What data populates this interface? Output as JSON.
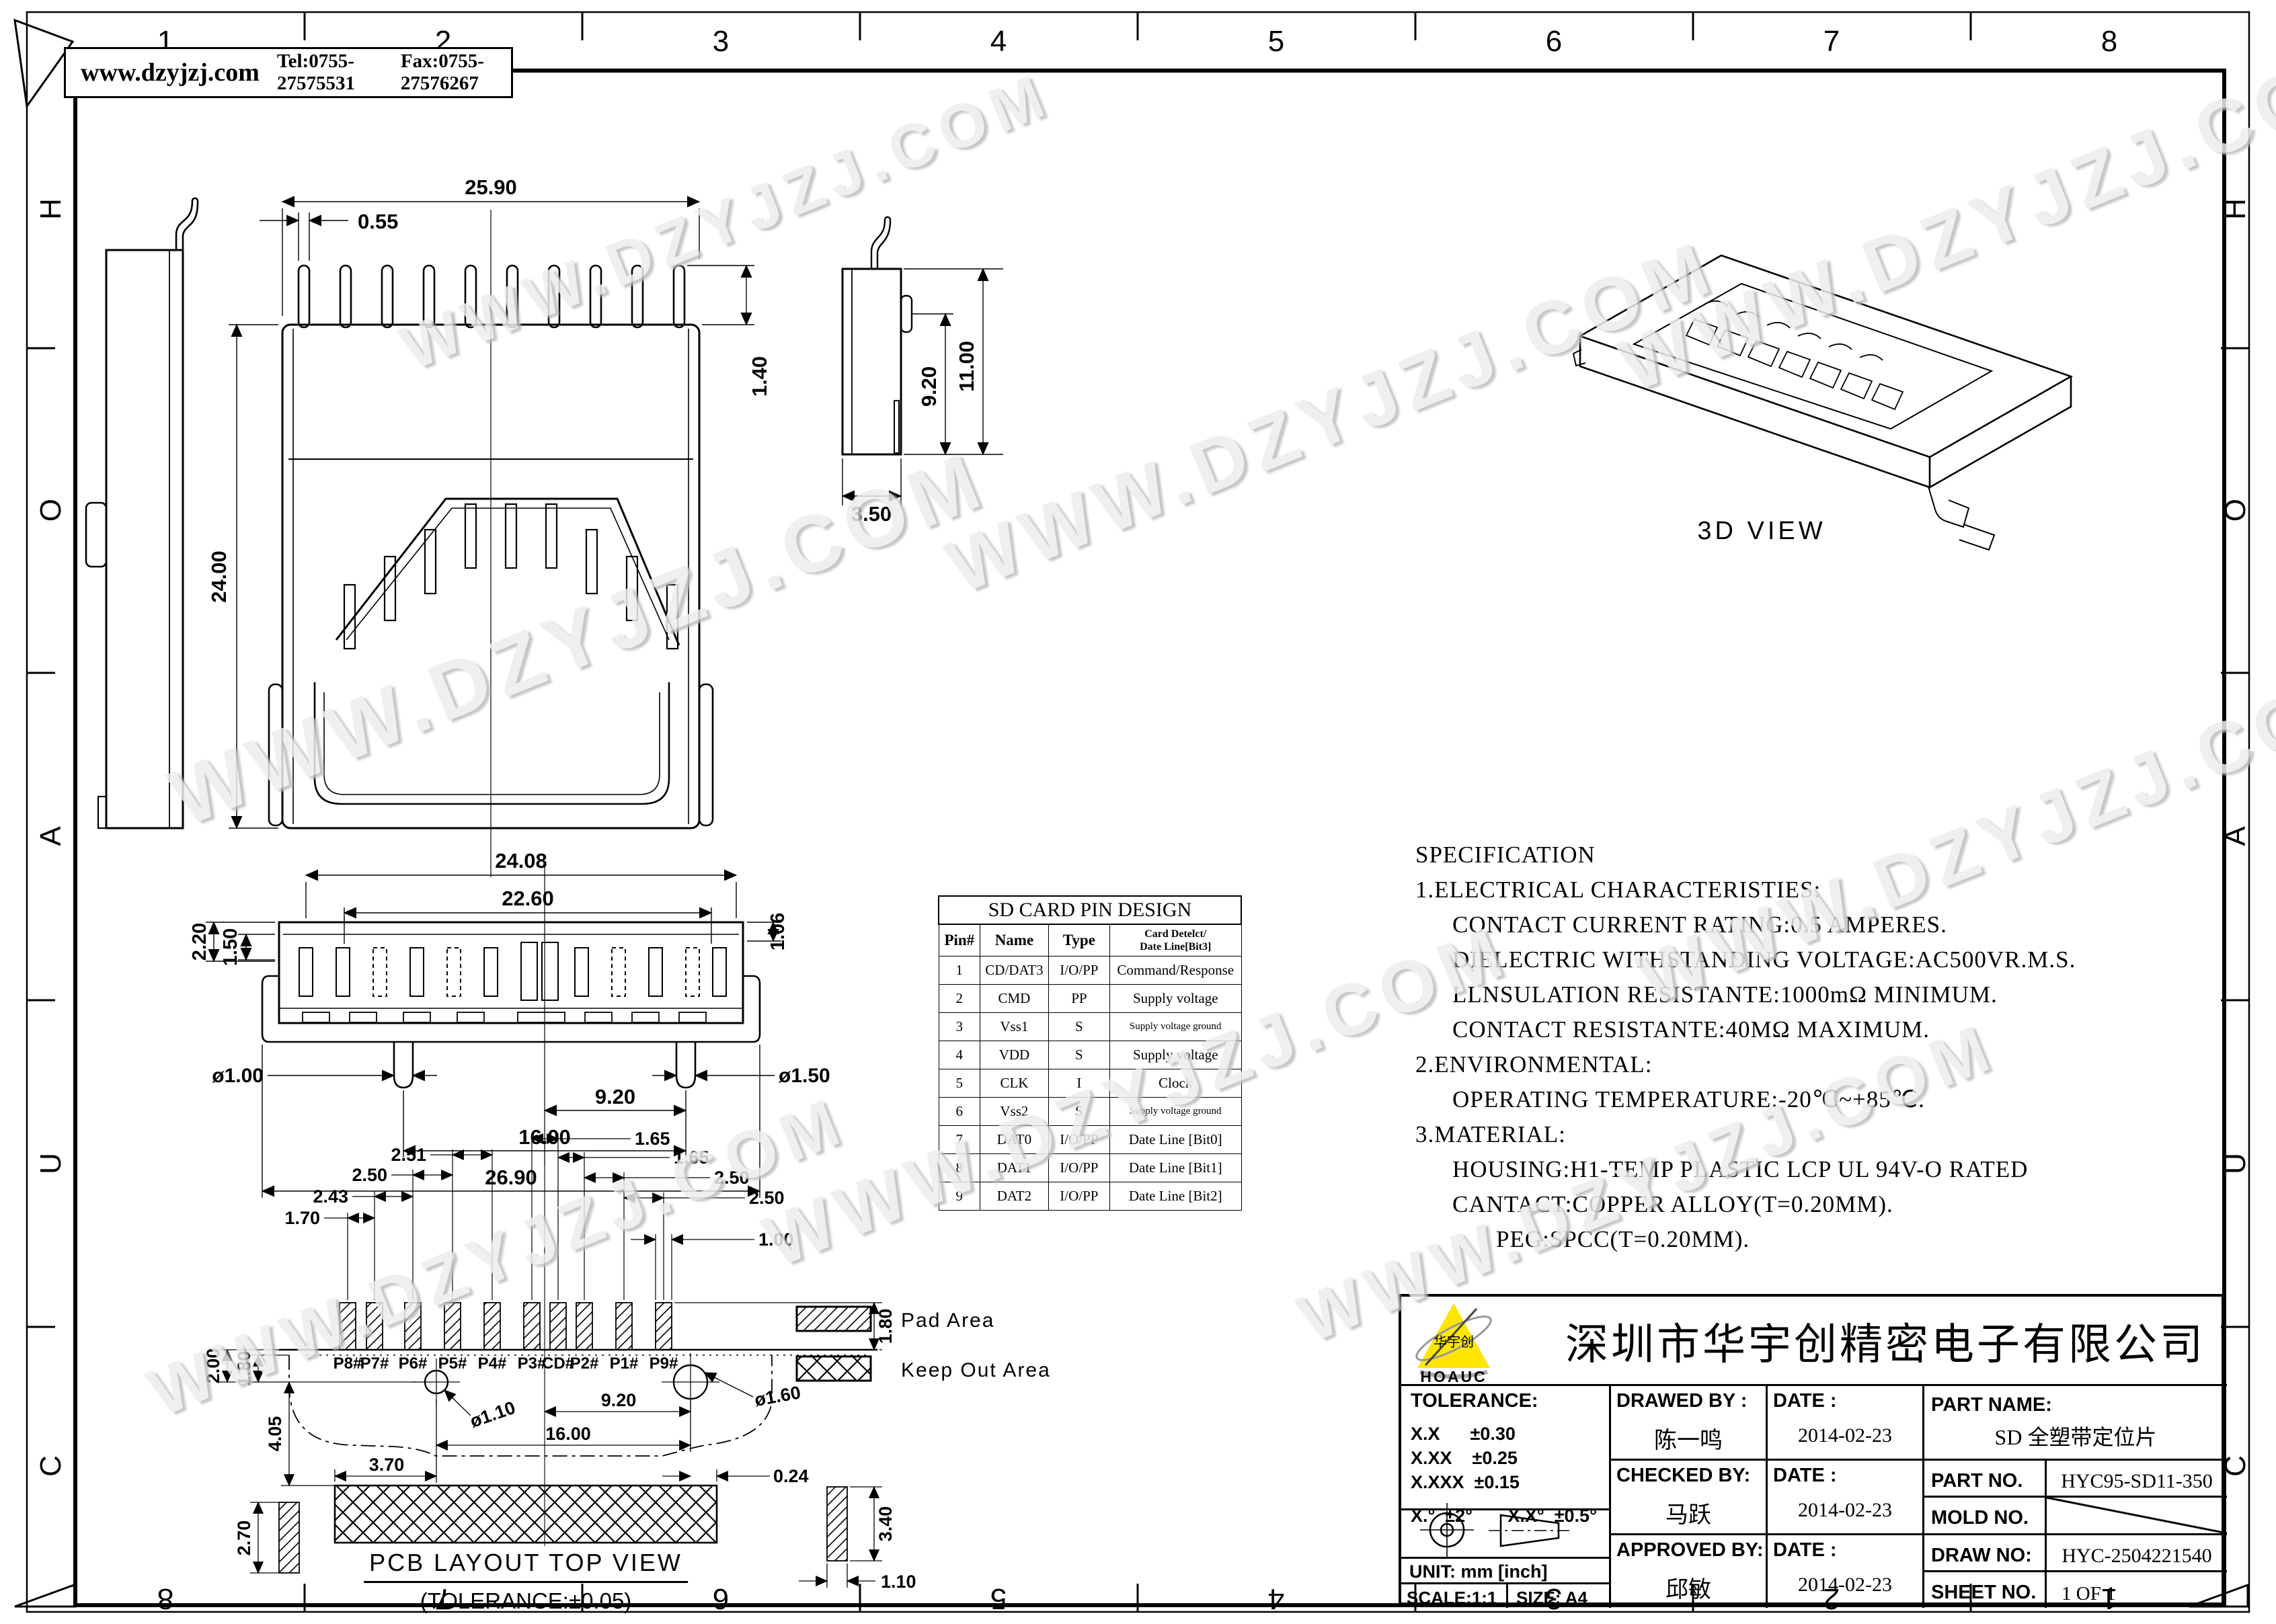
{
  "frame": {
    "zones_top": [
      "1",
      "2",
      "3",
      "4",
      "5",
      "6",
      "7",
      "8"
    ],
    "zones_bottom": [
      "8",
      "7",
      "6",
      "5",
      "4",
      "3",
      "2",
      "1"
    ],
    "zones_left": [
      "H",
      "O",
      "A",
      "U",
      "C"
    ],
    "zones_right": [
      "H",
      "O",
      "A",
      "U",
      "C"
    ]
  },
  "header": {
    "website": "www.dzyjzj.com",
    "tel": "Tel:0755-27575531",
    "fax": "Fax:0755-27576267"
  },
  "watermark": {
    "text": "WWW.DZYJZJ.COM"
  },
  "views": {
    "top": {
      "dims": {
        "width": "25.90",
        "pin": "0.55",
        "pin_depth": "1.40",
        "length": "24.00"
      }
    },
    "side": {
      "dims": {
        "inner": "9.20",
        "height": "11.00",
        "depth": "3.50"
      }
    },
    "front": {
      "dims": {
        "body": "24.08",
        "contacts": "22.60",
        "h1": "2.20",
        "h2": "1.50",
        "h3": "1.06",
        "peg_left": "ø1.00",
        "peg_right": "ø1.50",
        "half_span": "9.20",
        "peg_span": "16.00",
        "overall": "26.90"
      }
    },
    "iso": {
      "label": "3D VIEW"
    },
    "pcb": {
      "title": "PCB LAYOUT TOP VIEW",
      "tolerance_note": "(TOLERANCE:±0.05)",
      "pads": [
        "P8#",
        "P7#",
        "P6#",
        "P5#",
        "P4#",
        "P3#",
        "CD#",
        "P2#",
        "P1#",
        "P9#"
      ],
      "dims": {
        "r1": "1.65",
        "r2": "1.65",
        "r3": "2.50",
        "r4": "2.50",
        "r5": "1.00",
        "l1": "2.51",
        "l2": "2.50",
        "l3": "2.43",
        "l4": "1.70",
        "pad_h": "1.80",
        "v1": "2.00",
        "v2": "1.80",
        "v3": "4.05",
        "v4": "2.70",
        "hole_l": "ø1.10",
        "hole_r": "ø1.60",
        "half": "9.20",
        "span": "16.00",
        "edge_l": "3.70",
        "edge_r": "0.24",
        "pad_r_h": "3.40",
        "pad_r_w": "1.10"
      },
      "legend": {
        "pad": "Pad Area",
        "keepout": "Keep Out Area"
      }
    }
  },
  "pin_table": {
    "title": "SD CARD PIN DESIGN",
    "col1": "Pin#",
    "col2": "Name",
    "col3": "Type",
    "col4_line1": "Card Detelct/",
    "col4_line2": "Date Line[Bit3]",
    "rows": [
      [
        "1",
        "CD/DAT3",
        "I/O/PP",
        "Command/Response"
      ],
      [
        "2",
        "CMD",
        "PP",
        "Supply voltage"
      ],
      [
        "3",
        "Vss1",
        "S",
        "Supply voltage ground"
      ],
      [
        "4",
        "VDD",
        "S",
        "Supply voltage"
      ],
      [
        "5",
        "CLK",
        "I",
        "Clock"
      ],
      [
        "6",
        "Vss2",
        "S",
        "Supply voltage ground"
      ],
      [
        "7",
        "DAT0",
        "I/O/PP",
        "Date Line [Bit0]"
      ],
      [
        "8",
        "DAT1",
        "I/O/PP",
        "Date Line [Bit1]"
      ],
      [
        "9",
        "DAT2",
        "I/O/PP",
        "Date Line [Bit2]"
      ]
    ]
  },
  "specification": {
    "lines": [
      {
        "t": "SPECIFICATION"
      },
      {
        "t": "1.ELECTRICAL CHARACTERISTIES:"
      },
      {
        "t": "CONTACT CURRENT RATING:0.5 AMPERES."
      },
      {
        "t": "DIELECTRIC WITHSTANDING VOLTAGE:AC500VR.M.S."
      },
      {
        "t": "LLNSULATION RESISTANTE:1000mΩ MINIMUM."
      },
      {
        "t": "CONTACT RESISTANTE:40MΩ MAXIMUM."
      },
      {
        "t": "2.ENVIRONMENTAL:"
      },
      {
        "t": "OPERATING TEMPERATURE:-20℃~+85℃."
      },
      {
        "t": "3.MATERIAL:"
      },
      {
        "t": "HOUSING:H1-TEMP PLASTIC LCP UL 94V-O RATED"
      },
      {
        "t": "CANTACT:COPPER ALLOY(T=0.20MM)."
      },
      {
        "t": "PEG:SPCC(T=0.20MM)."
      }
    ]
  },
  "title_block": {
    "company": "深圳市华宇创精密电子有限公司",
    "logo": {
      "brand": "华宇创",
      "name": "HOAUC",
      "yellow": "#ffe600",
      "red": "#d42a1e"
    },
    "tolerance_label": "TOLERANCE:",
    "tol1": "X.X      ±0.30",
    "tol2": "X.XX    ±0.25",
    "tol3": "X.XXX  ±0.15",
    "ang1": "X.°  ±2°",
    "ang2": "X.X°  ±0.5°",
    "unit": "UNIT:  mm  [inch]",
    "scale": "SCALE:1:1",
    "size": "SIZE:  A4",
    "drawn_label": "DRAWED BY :",
    "drawn": "陈一鸣",
    "checked_label": "CHECKED BY:",
    "checked": "马跃",
    "approved_label": "APPROVED BY:",
    "approved": "邱敏",
    "date_label": "DATE :",
    "date1": "2014-02-23",
    "date2": "2014-02-23",
    "date3": "2014-02-23",
    "part_name_label": "PART NAME:",
    "part_name": "SD 全塑带定位片",
    "part_no_label": "PART NO.",
    "part_no": "HYC95-SD11-350",
    "mold_no_label": "MOLD NO.",
    "draw_no_label": "DRAW NO:",
    "draw_no": "HYC-2504221540",
    "sheet_no_label": "SHEET NO.",
    "sheet_no": "1 OF 1"
  }
}
